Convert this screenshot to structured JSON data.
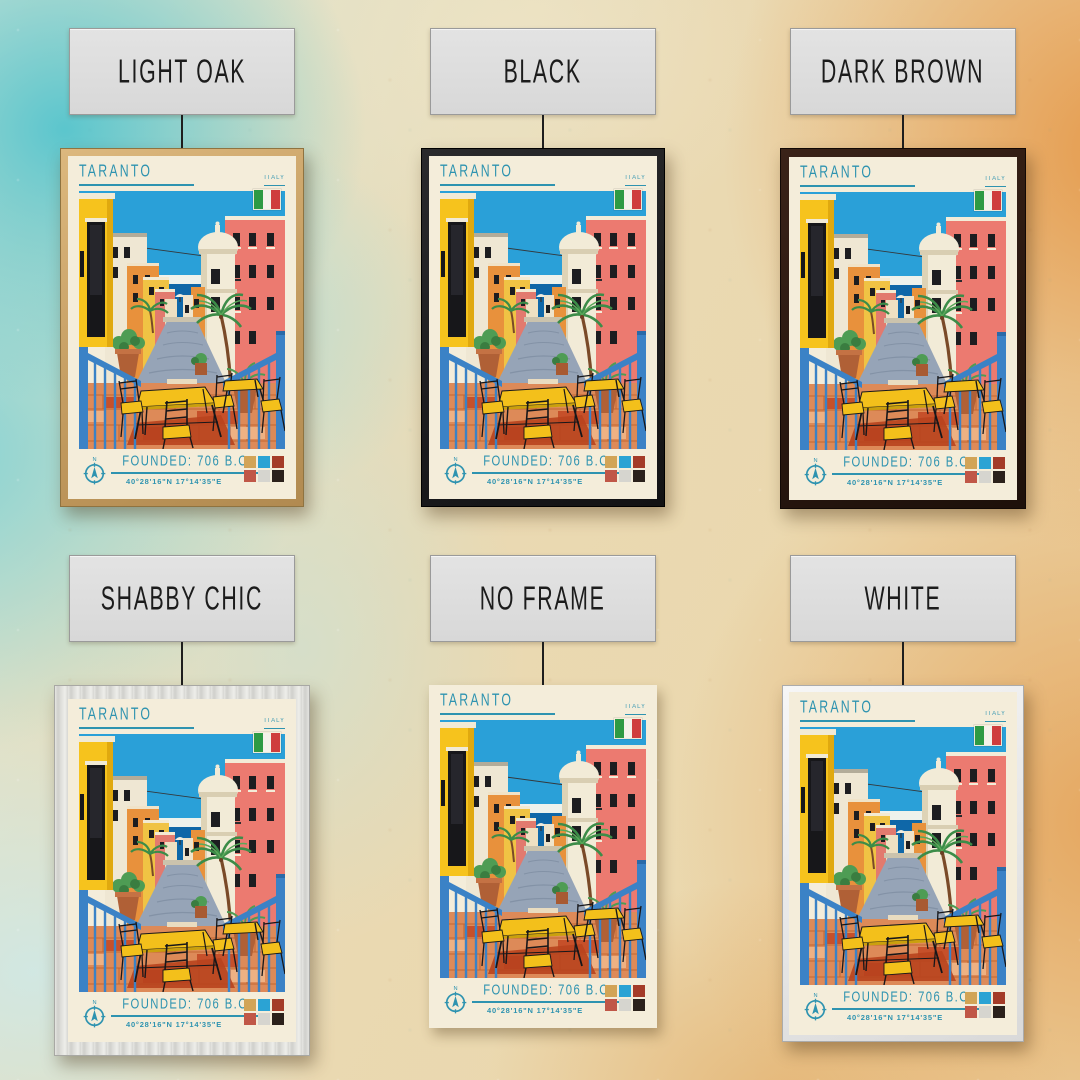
{
  "page": {
    "type": "framed-poster-product-mockup"
  },
  "colors": {
    "accent_teal": "#2e93b0",
    "poster_paper": "#f4edda",
    "label_bg": "#dcdcdc",
    "background_teal": "#64c4cc",
    "background_orange": "#e69a52",
    "background_cream": "#e9dcba"
  },
  "variants": [
    {
      "label": "LIGHT OAK",
      "frame": "light-oak"
    },
    {
      "label": "BLACK",
      "frame": "black"
    },
    {
      "label": "DARK BROWN",
      "frame": "dark-brown"
    },
    {
      "label": "SHABBY CHIC",
      "frame": "shabby-chic"
    },
    {
      "label": "NO FRAME",
      "frame": "no-frame"
    },
    {
      "label": "WHITE",
      "frame": "white"
    }
  ],
  "poster": {
    "title": "TARANTO",
    "country": "ITALY",
    "founded": "FOUNDED: 706 B.C.",
    "coordinates": "40°28'16\"N 17°14'35\"E",
    "compass_label": "N",
    "flag_colors": [
      "#2e9a44",
      "#f5f2ea",
      "#cf3d3d"
    ],
    "swatches": [
      "#d2a456",
      "#2ba3d4",
      "#a43b28",
      "#c05747",
      "#d6d5cf",
      "#2b211b"
    ]
  }
}
